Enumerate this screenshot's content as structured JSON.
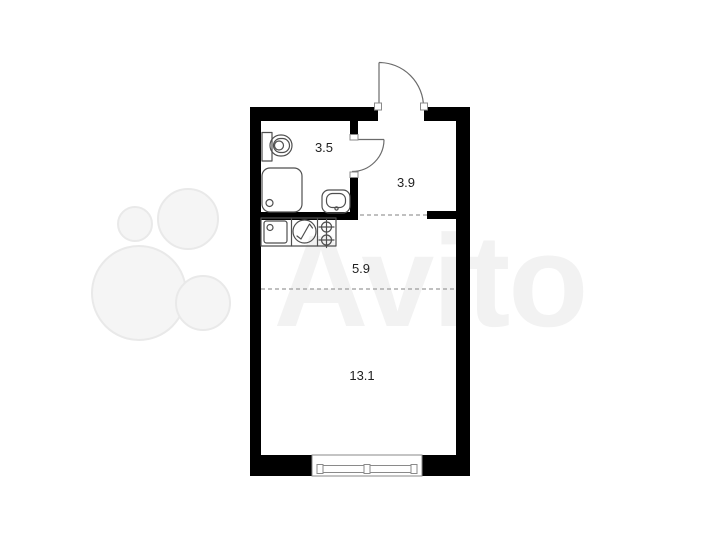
{
  "watermark": {
    "brand": "Avito",
    "logo": "avito-four-circles-logo"
  },
  "floor_plan": {
    "type": "studio-apartment-floor-plan",
    "rooms": [
      {
        "name": "bathroom",
        "area": "3.5"
      },
      {
        "name": "hallway",
        "area": "3.9"
      },
      {
        "name": "kitchen",
        "area": "5.9"
      },
      {
        "name": "living-room",
        "area": "13.1"
      }
    ],
    "fixtures": [
      "toilet",
      "shower-cabin",
      "washbasin",
      "kitchen-sink",
      "washing-machine",
      "two-burner-stove",
      "window",
      "entrance-door",
      "bathroom-door"
    ],
    "colors": {
      "wall": "#000000",
      "fixture_line": "#4f4f4f",
      "dashed_line": "#9b9b9b",
      "watermark": "#f2f2f2",
      "background": "#ffffff"
    }
  }
}
